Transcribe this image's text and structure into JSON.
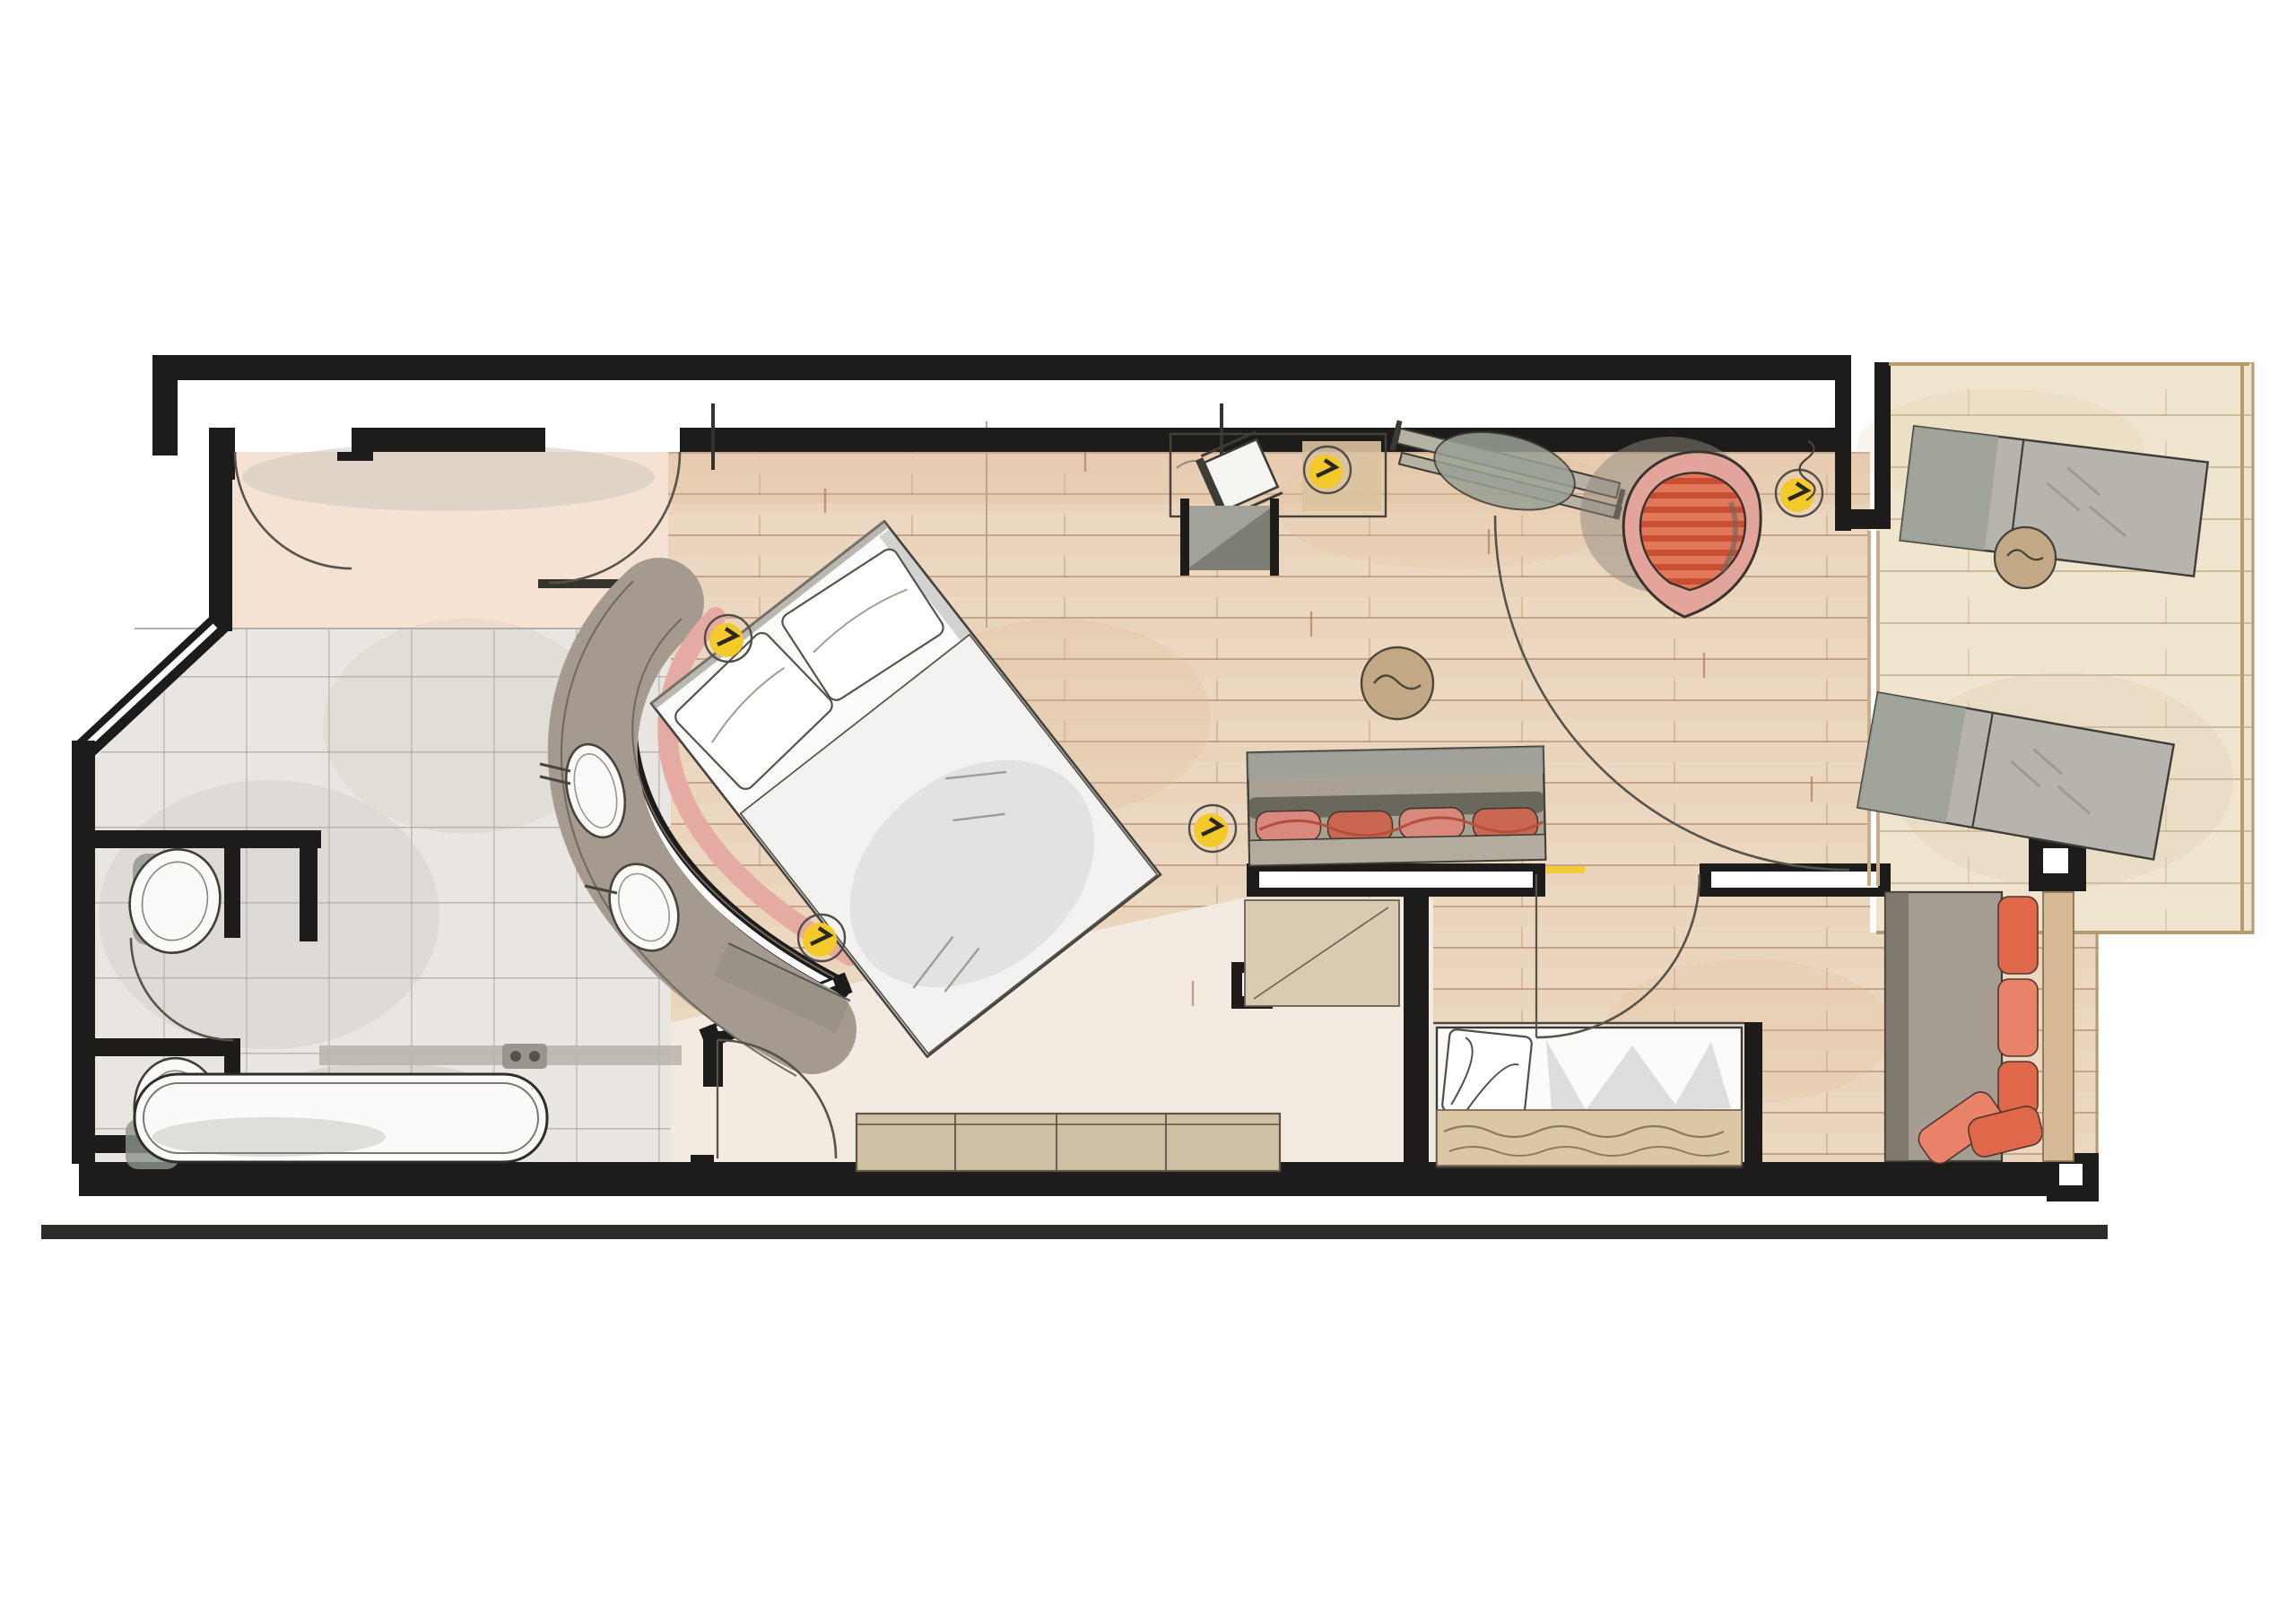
{
  "document": {
    "type": "hand-drawn watercolor floor plan",
    "text_labels": [],
    "rooms": [
      "entry-hall",
      "wc-upper",
      "wc-lower",
      "bathroom",
      "bedroom",
      "living-area",
      "dressing-corridor",
      "bed-niche",
      "lounge-alcove",
      "terrace"
    ]
  },
  "fixtures": {
    "ceiling_lights": 5,
    "door_swings": 6,
    "toilets": 2,
    "washbasins": 2,
    "bathtubs": 1,
    "beds": 2,
    "sofas": 2,
    "armchairs": 1,
    "sun_loungers": 3,
    "side_tables": 2
  },
  "palette": {
    "paper": "#ffffff",
    "ink": "#1d1c1a",
    "arc": "#56534b",
    "wood": "#ecd8c1",
    "woodAlt": "#e7ccb1",
    "woodLine": "#a5795a",
    "hall": "#f6e2d3",
    "dressing": "#f3ebe1",
    "niche": "#f0e9de",
    "tile": "#e9e5e0",
    "tileLine": "#7d786f",
    "tileWash": "#b3aea5",
    "terrace": "#efe4ce",
    "terraceLine": "#a98f66",
    "terraceEdge": "#b89a6f",
    "counter": "#a49a8f",
    "counterEdge": "#6e695f",
    "fixture": "#fbfaf8",
    "fixtureLine": "#46443d",
    "fixtureShadow": "#8f958f",
    "headboard": "#e5aba3",
    "linen": "#fbfbfa",
    "duvet": "#f3f2f0",
    "linenShade": "#cfcfd3",
    "bedOutline": "#55524a",
    "blanket": "#dcc7a4",
    "sideboard": "#cfc0a5",
    "sideboardEdge": "#5e5444",
    "wardrobe": "#d8cbb2",
    "sofa": "#a8a295",
    "sofaShadow": "#565349",
    "sofaSeat": "#b3ac9e",
    "cushionA": "#d9897b",
    "cushionB": "#c96753",
    "tableWood": "#c3a886",
    "stool": "#7d7d74",
    "stoolTop": "#a2a298",
    "deskPad": "#dcc3a0",
    "chairSeat": "#f7f5f2",
    "boardGray": "#b5b1a3",
    "boardCushion": "#99a095",
    "chairShell": "#e3a49c",
    "chairStripeA": "#e2775b",
    "chairStripeB": "#c94f33",
    "chairShadow": "#8e887c",
    "lounger": "#b7b4ad",
    "loungerShade": "#9aa096",
    "alcoveSofa": "#a69d92",
    "alcoveEdge": "#6d685e",
    "alcoveCushionA": "#e0684a",
    "alcoveCushionB": "#e8836a",
    "console": "#d6ba96",
    "light": "#f4c92a",
    "lightRing": "#514e46",
    "washGray": "#b5b0a8",
    "washTan": "#ddba97"
  }
}
